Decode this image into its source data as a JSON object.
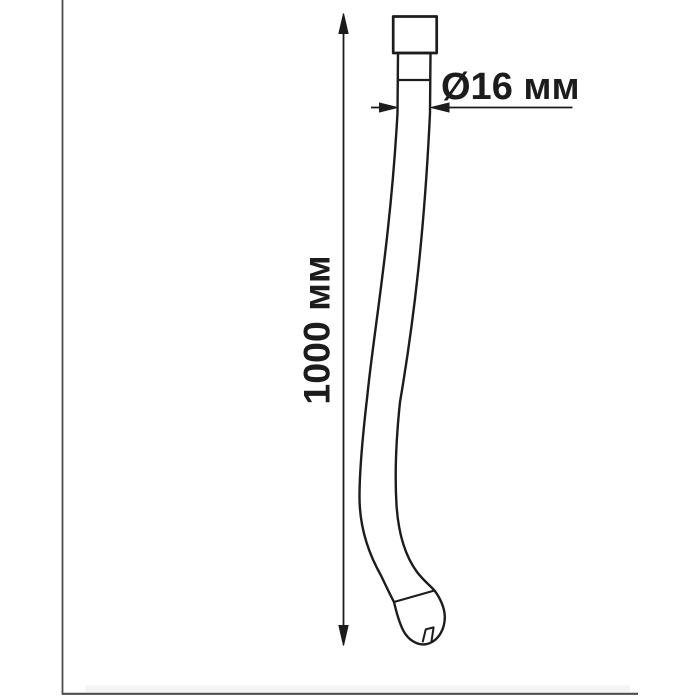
{
  "image": {
    "background": "#ffffff",
    "subject": "technical line drawing of a flexible gooseneck hose with dimension callouts"
  },
  "frame": {
    "color": "#4d4d4d"
  },
  "drawing": {
    "ink": "#1c1c1c",
    "dimension_labels": {
      "diameter": "Ø16 мм",
      "length": "1000 мм"
    },
    "dimension_values": {
      "diameter_mm": 16,
      "length_mm": 1000,
      "unit": "мм"
    }
  }
}
